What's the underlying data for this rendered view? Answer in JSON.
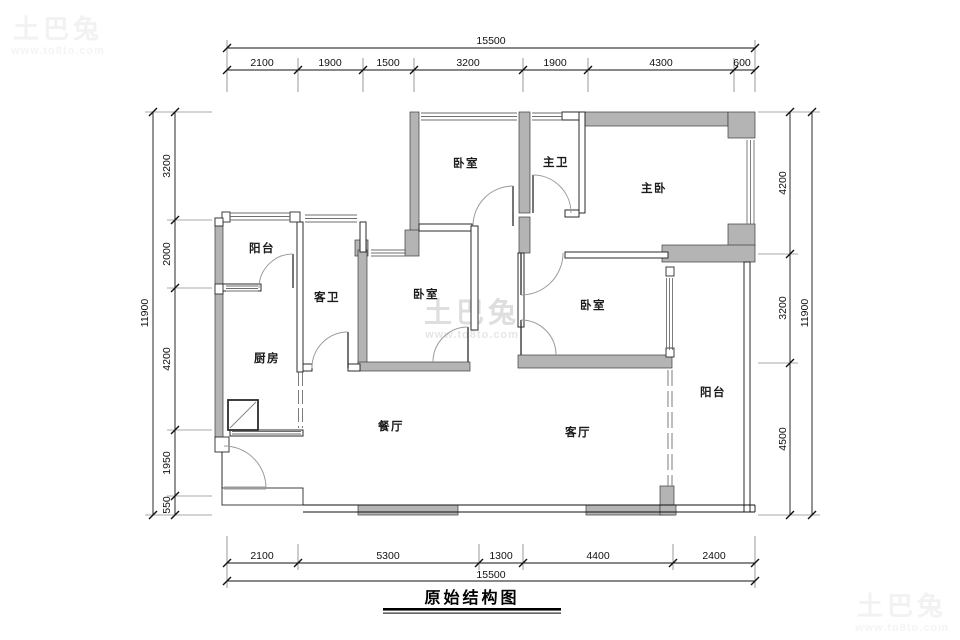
{
  "watermark": {
    "brand": "土巴兔",
    "url": "www.to8to.com"
  },
  "title": "原始结构图",
  "rooms": {
    "bedroom_top": "卧室",
    "master_bath": "主卫",
    "master_bedroom": "主卧",
    "balcony_left": "阳台",
    "guest_bath": "客卫",
    "bedroom_mid": "卧室",
    "bedroom_right": "卧室",
    "kitchen": "厨房",
    "dining": "餐厅",
    "living": "客厅",
    "balcony_right": "阳台"
  },
  "dimensions": {
    "top": {
      "total": "15500",
      "segments": [
        "2100",
        "1900",
        "1500",
        "3200",
        "1900",
        "4300",
        "600"
      ]
    },
    "bottom": {
      "total": "15500",
      "segments": [
        "2100",
        "5300",
        "1300",
        "4400",
        "2400"
      ]
    },
    "left": {
      "total": "11900",
      "segments": [
        "3200",
        "2000",
        "4200",
        "1950",
        "550"
      ]
    },
    "right": {
      "total": "11900",
      "segments": [
        "4200",
        "3200",
        "4500"
      ]
    }
  }
}
